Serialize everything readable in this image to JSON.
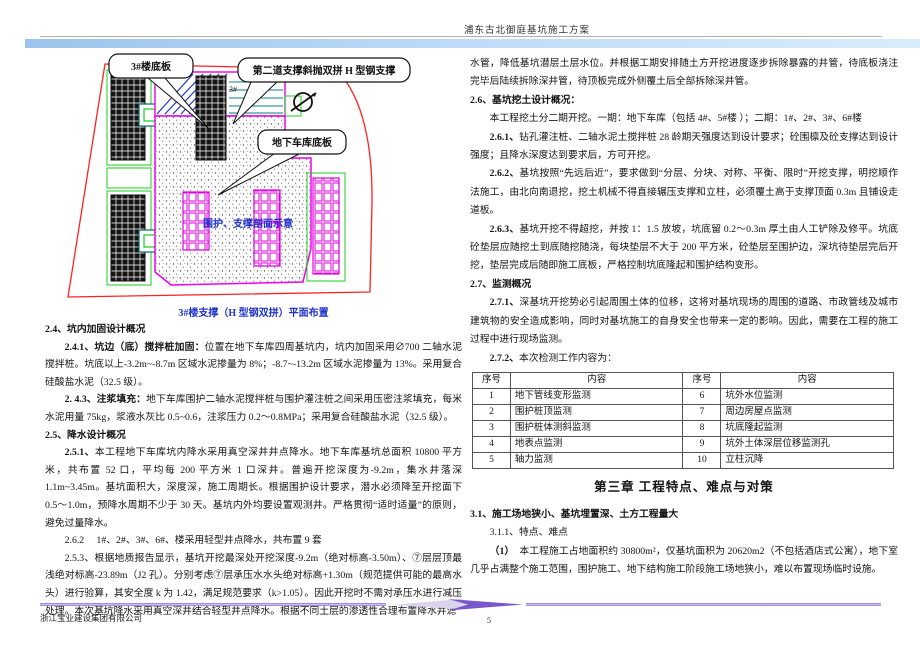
{
  "header": {
    "title": "浦东古北御庭基坑施工方案"
  },
  "diagram": {
    "callout_slab3": "3#楼底板",
    "callout_support": "第二道支撑斜抛双拼 H 型钢支撑",
    "callout_garage": "地下车库底板",
    "bldg3_label": "3#",
    "section_label": "围护、支撑剖面示意",
    "caption": "3#楼支撑（H 型钢双拼）平面布置",
    "colors": {
      "boundary": "#ff2222",
      "pit_outline": "#ee00ee",
      "plot_green": "#1ecc1e",
      "strut_blue": "#1a35cc",
      "label_blue": "#2233cc"
    }
  },
  "left_column": {
    "s24_heading": "2.4、坑内加固设计概况",
    "s241_lead": "2.4.1、坑边（底）搅拌桩加固：",
    "s241_text": "位置在地下车库四周基坑内，坑内加固采用∅700 二轴水泥搅拌桩。坑底以上-3.2m~-8.7m 区域水泥掺量为 8%；-8.7~-13.2m 区域水泥掺量为 13%。采用复合硅酸盐水泥（32.5 级）。",
    "s243_lead": "2. 4.3、注浆填充：",
    "s243_text": "地下车库围护二轴水泥搅拌桩与围护灌注桩之间采用压密注浆填充，每米水泥用量 75kg，浆液水灰比 0.5~0.6，注浆压力 0.2～0.8MPa；采用复合硅酸盐水泥（32.5 级）。",
    "s25_heading": "2.5、降水设计概况",
    "s251_lead": "2.5.1、",
    "s251_text": "本工程地下车库坑内降水采用真空深井井点降水。地下车库基坑总面积 10800 平方米，共布置 52 口，平均每 200 平方米 1 口深井。普遍开挖深度为-9.2m，集水井落深 1.1m~3.45m。基坑面积大，深度深，施工周期长。根据围护设计要求，潜水必须降至开挖面下 0.5～1.0m，预降水周期不少于 30 天。基坑内外均要设置观测井。严格贯彻“适时适量”的原则，避免过量降水。",
    "s262_line": "2.6.2　 1#、2#、3#、6#、楼采用轻型井点降水，共布置 9 套",
    "s253_lead": "2.5.3、",
    "s253_text": "根据地质报告显示，基坑开挖最深处开挖深度-9.2m（绝对标高-3.50m）、⑦层层顶最浅绝对标高-23.89m（J2 孔）。分别考虑⑦层承压水水头绝对标高+1.30m（规范提供可能的最高水头）进行验算，其安全度 k 为 1.42，满足规范要求（k>1.05）。因此开挖时不需对承压水进行减压处理。本次基坑降水采用真空深井结合轻型井点降水。根据不同土层的渗透性合理布置降水井滤"
  },
  "right_column": {
    "p_continuation": "水管，降低基坑潜层土层水位。并根据工期安排随土方开挖进度逐步拆除暴露的井管，待底板浇注完毕后陆续拆除深井管，待顶板完成外侧覆土后全部拆除深井管。",
    "s26_heading": "2.6、基坑挖土设计概况：",
    "s26_intro": "本工程挖土分二期开挖。一期：地下车库（包括 4#、5#楼 ）；二期：1#、2#、3#、6#楼",
    "s261_lead": "2.6.1、",
    "s261_text": "钻孔灌注桩、二轴水泥土搅拌桩 28 龄期天强度达到设计要求；砼围檩及砼支撑达到设计强度；且降水深度达到要求后，方可开挖。",
    "s262_lead": "2.6.2、",
    "s262_text": "基坑按照“先远后近”，要求做到“分层、分块、对称、平衡、限时”开挖支撑，明挖顺作法施工，由北向南退挖，挖土机械不得直接辗压支撑和立柱，必须覆土高于支撑顶面 0.3m 且铺设走道板。",
    "s263_lead": "2.6.3、",
    "s263_text": "基坑开挖不得超挖，并按 1：1.5 放坡，坑底留 0.2～0.3m 厚土由人工铲除及修平。坑底砼垫层应随挖土到底随挖随浇，每块垫层不大于 200 平方米，砼垫层至围护边，深坑待垫层完后开挖，垫层完成后随即施工底板，严格控制坑底隆起和围护结构变形。",
    "s27_heading": "2.7、监测概况",
    "s271_lead": "2.7.1、",
    "s271_text": "深基坑开挖势必引起周围土体的位移，这将对基坑现场的周围的道路、市政管线及城市建筑物的安全造成影响，同时对基坑施工的自身安全也带来一定的影响。因此，需要在工程的施工过程中进行现场监测。",
    "s272_lead": "2.7.2、",
    "s272_text": "本次检测工作内容为：",
    "monitor_table": {
      "headers": [
        "序号",
        "内容",
        "序号",
        "内容"
      ],
      "rows": [
        [
          "1",
          "地下管线变形监测",
          "6",
          "坑外水位监测"
        ],
        [
          "2",
          "围护桩顶监测",
          "7",
          "周边房屋点监测"
        ],
        [
          "3",
          "围护桩体测斜监测",
          "8",
          "坑底隆起监测"
        ],
        [
          "4",
          "地表点监测",
          "9",
          "坑外土体深层位移监测孔"
        ],
        [
          "5",
          "轴力监测",
          "10",
          "立柱沉降"
        ]
      ]
    },
    "chapter_heading": "第三章 工程特点、难点与对策",
    "s31_heading": "3.1、施工场地狭小、基坑埋置深、土方工程量大",
    "s311_line": "3.1.1、特点、难点",
    "p31_lead": "（1）　",
    "p31_text": "本工程施工占地面积约 30800m²，仅基坑面积为 20620m2（不包括酒店式公寓），地下室几乎占满整个施工范围，围护施工、地下结构施工阶段施工场地狭小，难以布置现场临时设施。"
  },
  "footer": {
    "company": "浙江宝业建设集团有限公司",
    "page_number": "5"
  }
}
